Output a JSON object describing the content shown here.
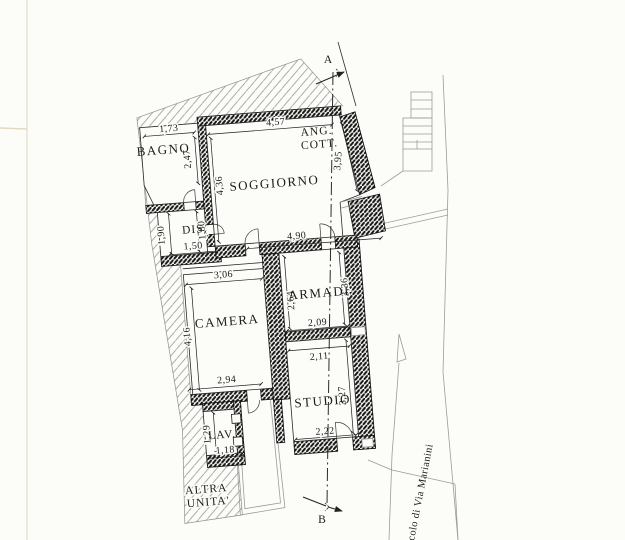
{
  "plan": {
    "rooms": {
      "bagno": "BAGNO",
      "soggiorno": "SOGGIORNO",
      "ang_cott_1": "ANG.",
      "ang_cott_2": "COTT.",
      "dis": "DIS.",
      "camera": "CAMERA",
      "armadi": "ARMADI",
      "studio": "STUDIO",
      "lav": "LAV.",
      "altra_1": "ALTRA",
      "altra_2": "UNITA'"
    },
    "dims": {
      "bagno_w": "1,73",
      "bagno_h": "2,47",
      "sogg_w": "4,57",
      "sogg_h": "4,36",
      "angcott_h": "3,95",
      "dis_h_left": "1,90",
      "dis_h_right": "1,80",
      "dis_w": "1,50",
      "sogg_s": "4,90",
      "camera_w": "3,06",
      "camera_h": "4,16",
      "camera_s": "2,94",
      "armadi_h_left": "2,64",
      "armadi_h_right": "3,36",
      "armadi_s": "2,09",
      "studio_n": "2,11",
      "studio_h": "3,27",
      "studio_s": "2,22",
      "lav_h": "1,29",
      "lav_w": "1,18"
    },
    "section": {
      "top": "A",
      "bottom": "B"
    },
    "street": "colo di Via Marianini"
  }
}
